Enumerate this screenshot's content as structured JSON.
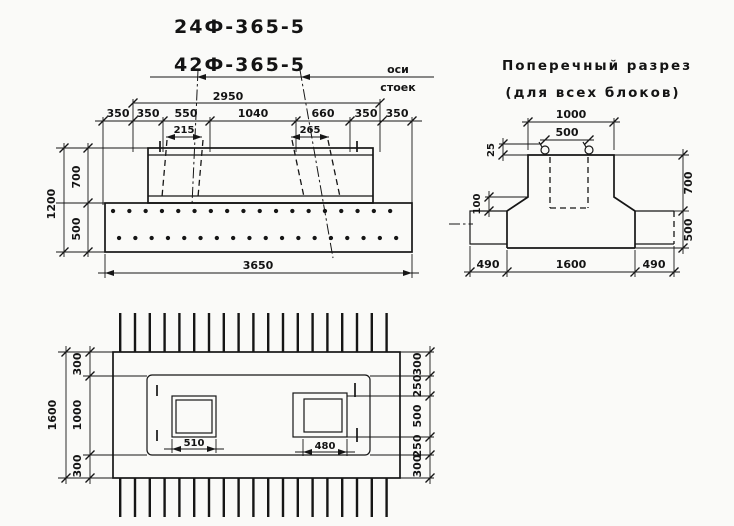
{
  "page": {
    "paper_color": "#fafaf8",
    "ink_color": "#161616"
  },
  "titles": {
    "mark_a": "24Ф-365-5",
    "mark_b": "42Ф-365-5"
  },
  "elevation": {
    "leader_line1": "оси",
    "leader_line2": "стоек",
    "dim_axes_span": "2950",
    "dims_top": [
      "350",
      "350",
      "550",
      "1040",
      "660",
      "350",
      "350"
    ],
    "dim_socket_left": "215",
    "dim_socket_right": "265",
    "dim_height_total": "1200",
    "dim_height_upper": "700",
    "dim_height_lower": "500",
    "dim_length_total": "3650"
  },
  "cross_section": {
    "title_line1": "Поперечный разрез",
    "title_line2": "(для всех блоков)",
    "dim_top_width": "1000",
    "dim_socket_width": "500",
    "dim_ledge": "25",
    "dim_haunch": "100",
    "dim_height_upper": "700",
    "dim_height_lower": "500",
    "dims_bottom": [
      "490",
      "1600",
      "490"
    ]
  },
  "plan": {
    "dim_width_total": "1600",
    "dims_left_chain": [
      "300",
      "1000",
      "300"
    ],
    "dims_right_chain": [
      "300",
      "250",
      "500",
      "250",
      "300"
    ],
    "dim_socket_left": "510",
    "dim_socket_right": "480"
  }
}
